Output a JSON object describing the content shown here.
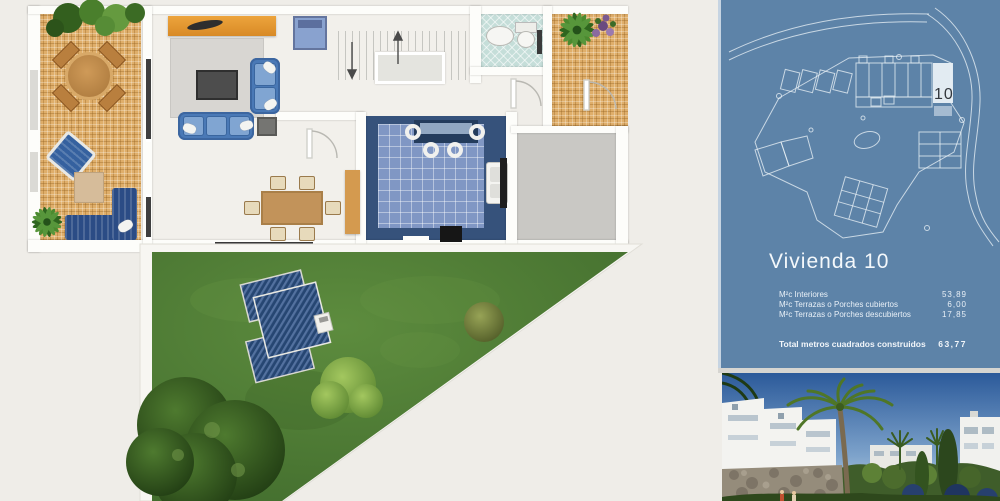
{
  "panel": {
    "title": "Vivienda 10",
    "site_plan": {
      "unit_label": "10"
    },
    "area_rows": [
      {
        "label": "M²c Interiores",
        "value": "53,89"
      },
      {
        "label": "M²c Terrazas o Porches cubiertos",
        "value": "6,00"
      },
      {
        "label": "M²c Terrazas o Porches descubiertos",
        "value": "17,85"
      }
    ],
    "total": {
      "label": "Total metros cuadrados construidos",
      "value": "63,77"
    },
    "colors": {
      "panel_bg": "#5d83a8",
      "blueprint_line": "#e8eff5",
      "text": "#f2f6fa"
    }
  },
  "floor_plan": {
    "colors": {
      "background": "#efede8",
      "wall": "#fdfdfa",
      "terrace_tile": "#dfae6a",
      "kitchen_tile": "#8097c4",
      "kitchen_border": "#36527b",
      "bath_tile": "#c5ded9",
      "lawn_green": "#4c7a35",
      "sofa_blue": "#4a79b6",
      "wood": "#c2935a",
      "roof_navy": "#264672"
    }
  }
}
